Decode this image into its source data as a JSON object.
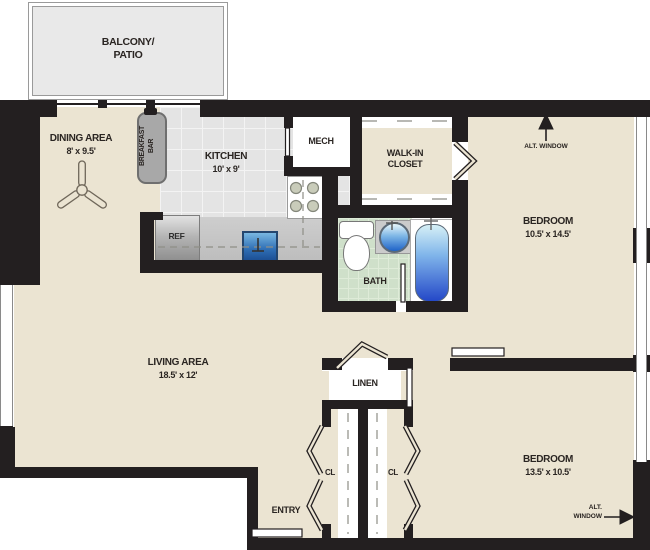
{
  "plan_title": "Apartment floor plan",
  "rooms": {
    "balcony": {
      "line1": "BALCONY/",
      "line2": "PATIO"
    },
    "dining": {
      "name": "DINING AREA",
      "dims": "8' x 9.5'"
    },
    "kitchen": {
      "name": "KITCHEN",
      "dims": "10' x 9'"
    },
    "breakfast_bar": {
      "line1": "BREAKFAST",
      "line2": "BAR"
    },
    "mech": {
      "name": "MECH"
    },
    "walk_in_closet": {
      "line1": "WALK-IN",
      "line2": "CLOSET"
    },
    "bath": {
      "name": "BATH"
    },
    "bedroom1": {
      "name": "BEDROOM",
      "dims": "10.5' x 14.5'"
    },
    "living": {
      "name": "LIVING AREA",
      "dims": "18.5' x 12'"
    },
    "linen": {
      "name": "LINEN"
    },
    "closet_left": {
      "name": "CL"
    },
    "closet_right": {
      "name": "CL"
    },
    "bedroom2": {
      "name": "BEDROOM",
      "dims": "13.5' x 10.5'"
    },
    "entry": {
      "name": "ENTRY"
    }
  },
  "fixtures": {
    "refrigerator": "REF"
  },
  "annotations": {
    "alt_window_top": "ALT. WINDOW",
    "alt_window_bottom_line1": "ALT.",
    "alt_window_bottom_line2": "WINDOW"
  },
  "colors": {
    "wall": "#231f20",
    "floor_beige": "#ebe4d2",
    "balcony_gray": "#e9e9e9",
    "kitchen_tile": "#e4e4e4",
    "bath_tile": "#cfe0ca",
    "counter_gray": "#c6c6c6",
    "bar_gray": "#a8a8a8",
    "water_light": "#d6f0f6",
    "water_dark": "#2448c8",
    "outline": "#8a8a8a"
  }
}
